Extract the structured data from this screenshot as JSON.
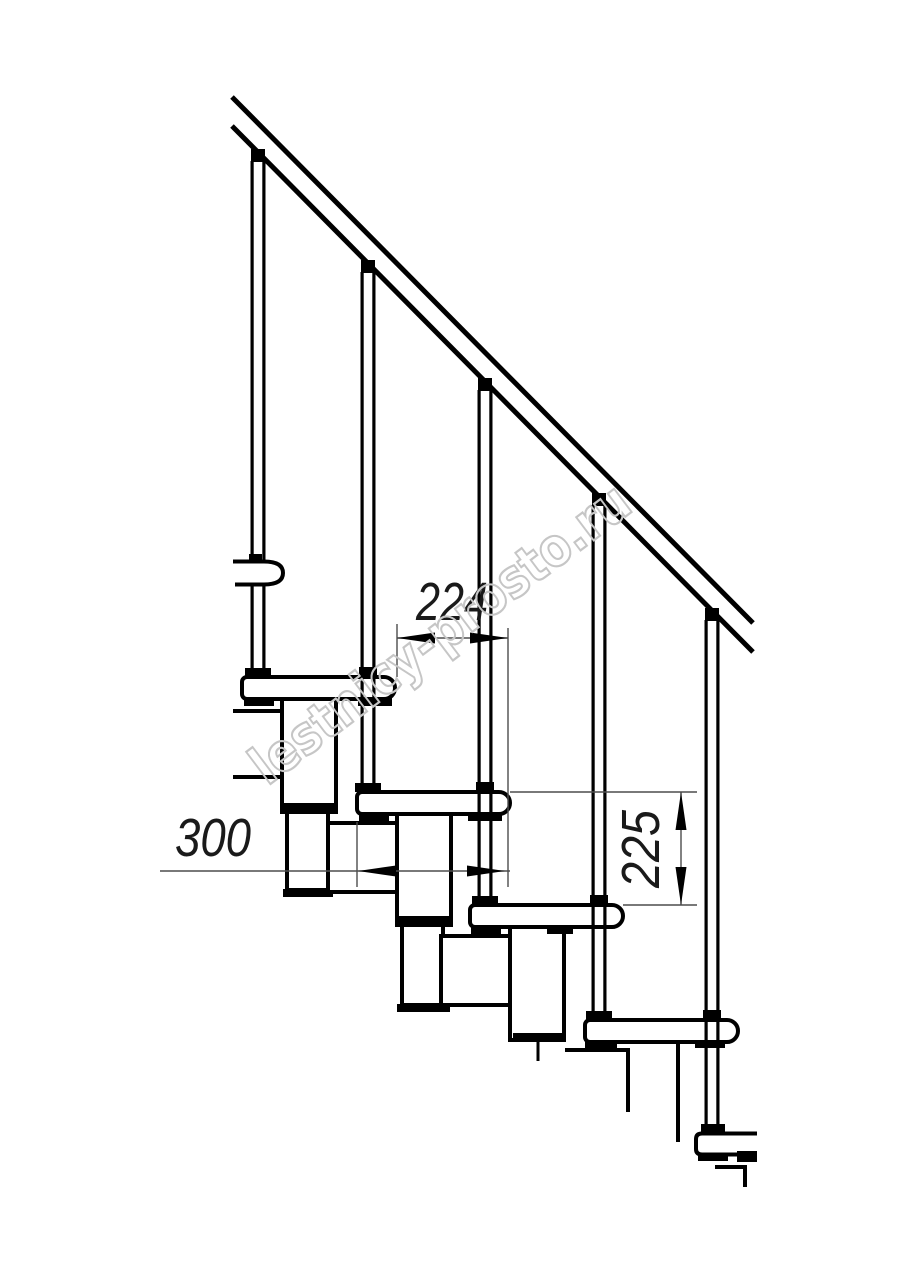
{
  "drawing": {
    "background_color": "#ffffff",
    "line_color": "#000000",
    "thin_line_color": "#4d4d4d",
    "dimensions": {
      "tread_overlap": {
        "value": "224",
        "orientation": "horizontal"
      },
      "step_depth": {
        "value": "300",
        "orientation": "horizontal"
      },
      "step_rise": {
        "value": "225",
        "orientation": "vertical"
      }
    },
    "watermark": {
      "text": "lestnicy-prosto.ru",
      "color": "#c6c6c6"
    }
  }
}
